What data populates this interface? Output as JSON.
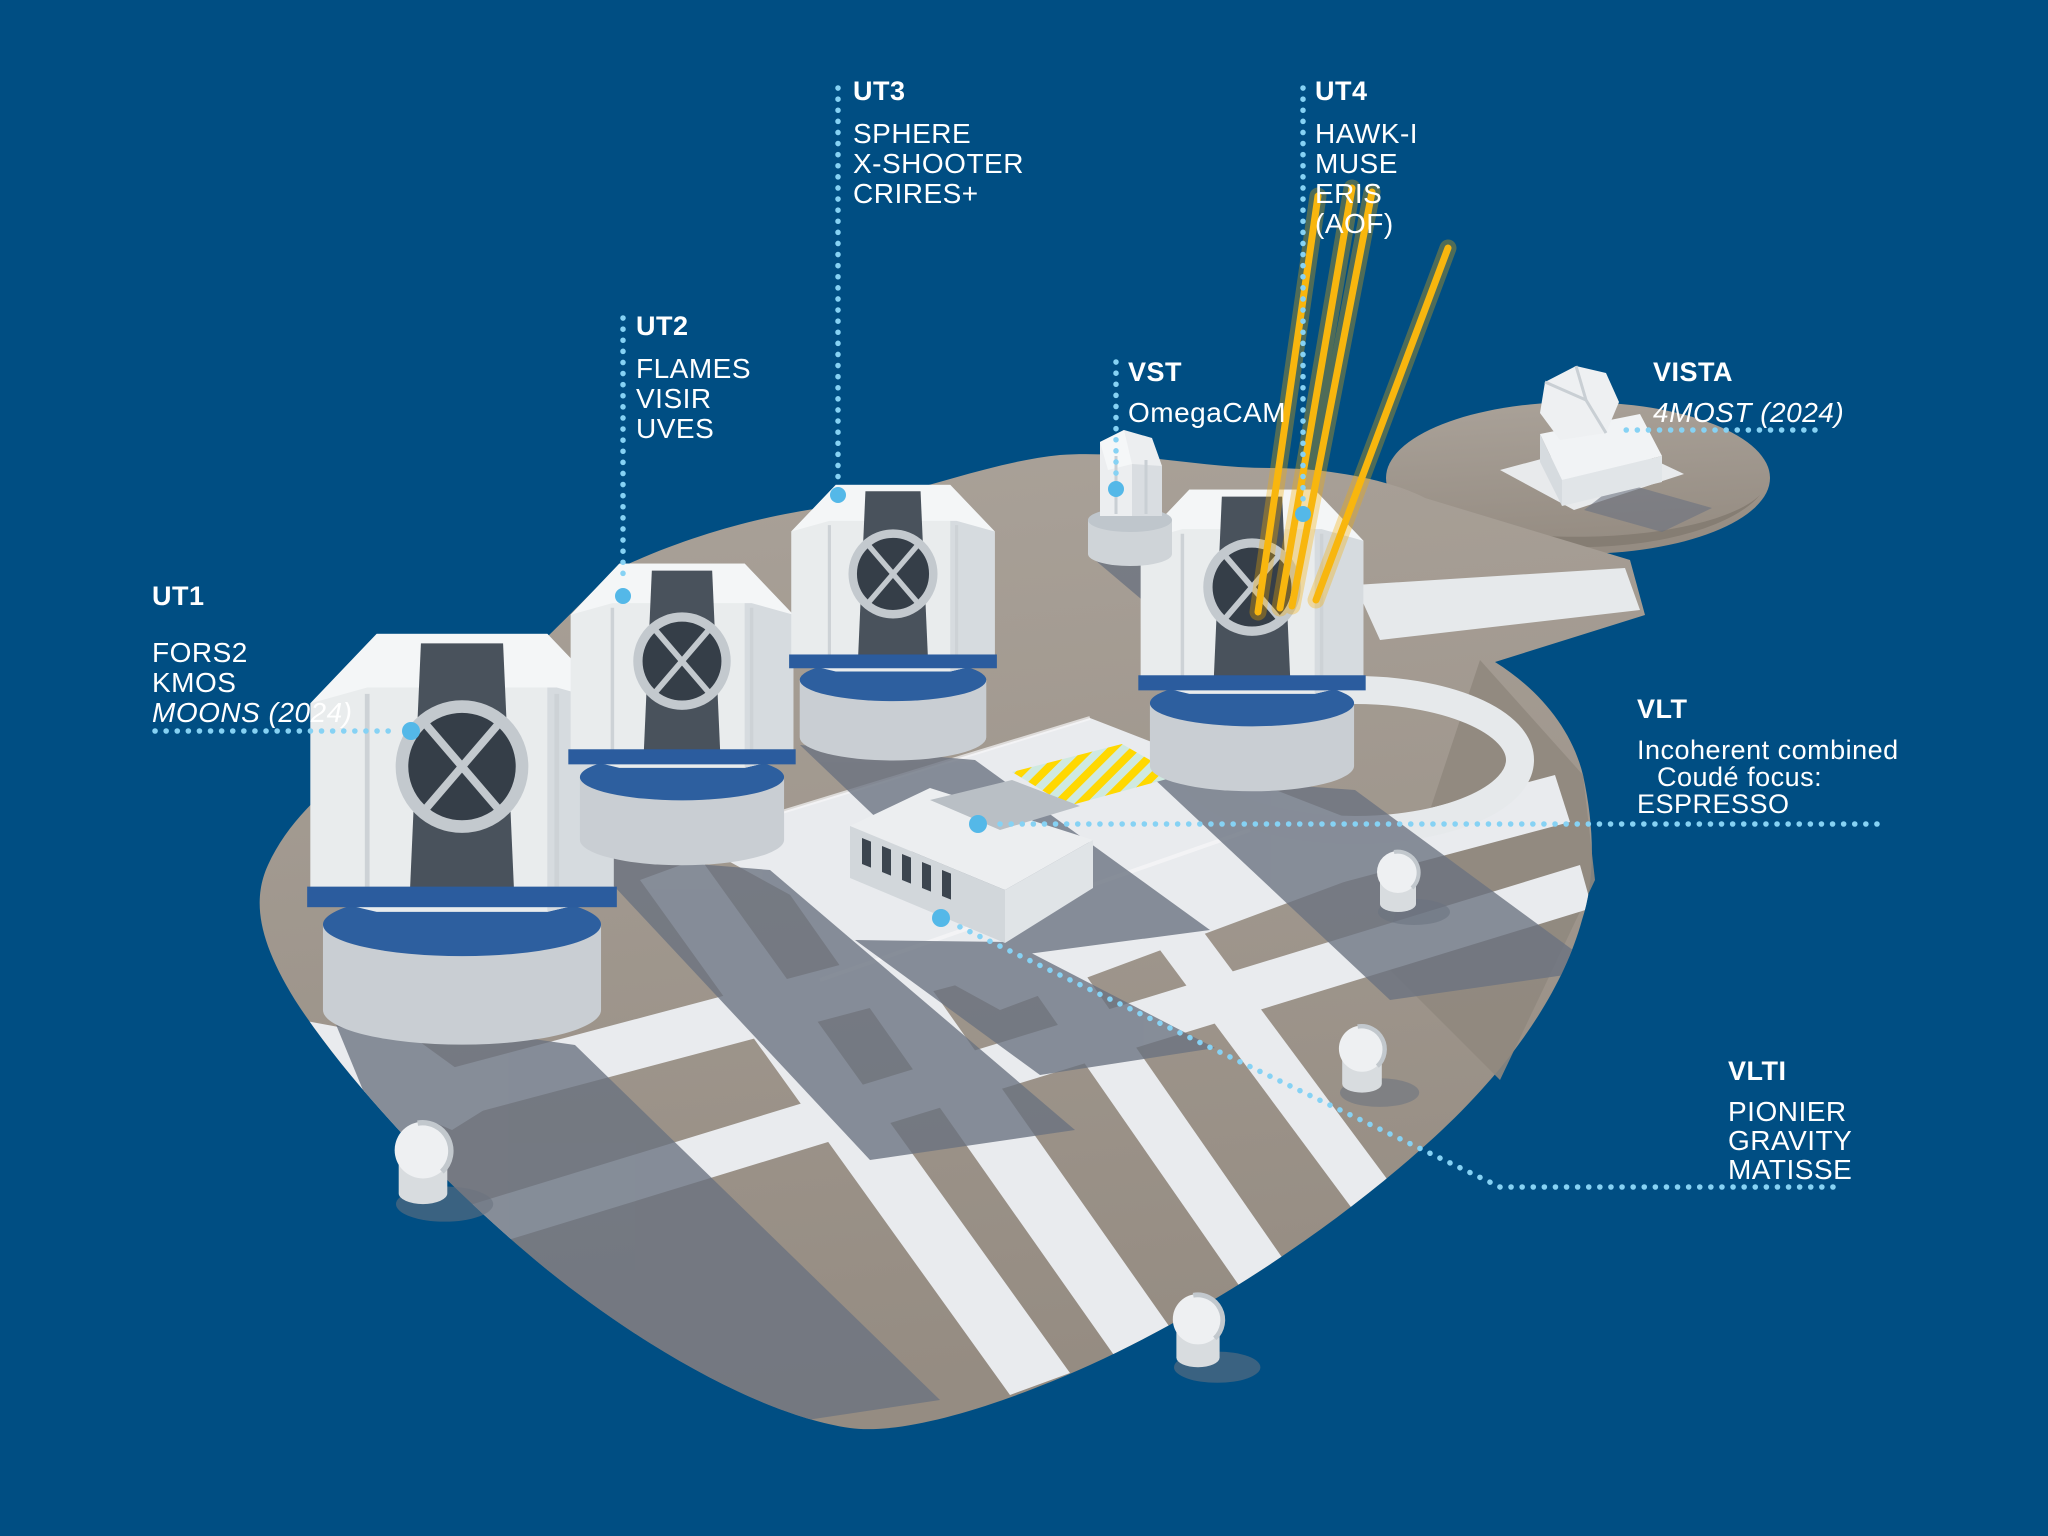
{
  "scene": {
    "background": "#004e83",
    "text_white": "#ffffff",
    "text_accent": "#7cc2e8",
    "dotted_line": "#7fd0f2",
    "dot_endpoint": "#54b8e8",
    "laser": "#f6ad00",
    "platform_gray": "#a49b91",
    "pavement_white": "#e9ebee",
    "shadow_gray": "#6a7280",
    "telescope_blue": "#2d5f9f"
  },
  "labels": {
    "ut1": {
      "title": "UT1",
      "lines": [
        {
          "text": "FORS2"
        },
        {
          "text": "KMOS"
        },
        {
          "text": "MOONS (2024)"
        }
      ]
    },
    "ut2": {
      "title": "UT2",
      "lines": [
        {
          "text": "FLAMES"
        },
        {
          "text": "VISIR"
        },
        {
          "text": "UVES"
        }
      ]
    },
    "ut3": {
      "title": "UT3",
      "lines": [
        {
          "text": "SPHERE"
        },
        {
          "text": "X-SHOOTER"
        },
        {
          "text": "CRIRES+"
        }
      ]
    },
    "ut4": {
      "title": "UT4",
      "lines": [
        {
          "text": "HAWK-I"
        },
        {
          "text": "MUSE"
        },
        {
          "text": "ERIS"
        },
        {
          "text": "(AOF)"
        }
      ]
    },
    "vst": {
      "title": "VST",
      "lines": [
        {
          "text": "OmegaCAM"
        }
      ]
    },
    "vista": {
      "title": "VISTA",
      "lines": [
        {
          "text": "4MOST (2024)"
        }
      ]
    },
    "vlt": {
      "title": "VLT",
      "lines": [
        {
          "text": "Incoherent combined"
        },
        {
          "text": "Coudé focus:"
        },
        {
          "text": "ESPRESSO"
        }
      ]
    },
    "vlti": {
      "title": "VLTI",
      "lines": [
        {
          "text": "PIONIER"
        },
        {
          "text": "GRAVITY"
        },
        {
          "text": "MATISSE"
        }
      ]
    }
  }
}
